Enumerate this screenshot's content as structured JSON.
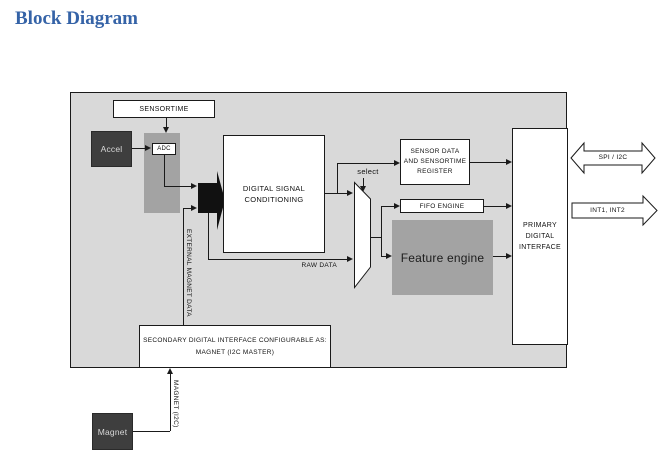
{
  "page": {
    "title": "Block Diagram"
  },
  "diagram": {
    "blocks": {
      "sensortime": "SENSORTIME",
      "accel": "Accel",
      "adc": "ADC",
      "dsc": "DIGITAL SIGNAL\nCONDITIONING",
      "sensor_data_register": "SENSOR DATA\nAND SENSORTIME\nREGISTER",
      "fifo_engine": "FIFO ENGINE",
      "feature_engine": "Feature engine",
      "primary_interface": "PRIMARY\nDIGITAL\nINTERFACE",
      "secondary_interface": "SECONDARY DIGITAL INTERFACE CONFIGURABLE AS:\nMAGNET (I2C MASTER)",
      "magnet": "Magnet"
    },
    "labels": {
      "select": "select",
      "raw_data": "RAW DATA",
      "external_magnet_data": "EXTERNAL MAGNET DATA",
      "magnet_i2c": "MAGNET (I2C)",
      "spi_i2c": "SPI / I2C",
      "interrupts": "INT1, INT2"
    },
    "colors": {
      "title_blue": "#3563a7",
      "canvas_gray": "#d9d9d9",
      "mid_gray": "#a3a3a3",
      "dark_block": "#3e3e3e",
      "line_black": "#1a1a1a"
    }
  }
}
